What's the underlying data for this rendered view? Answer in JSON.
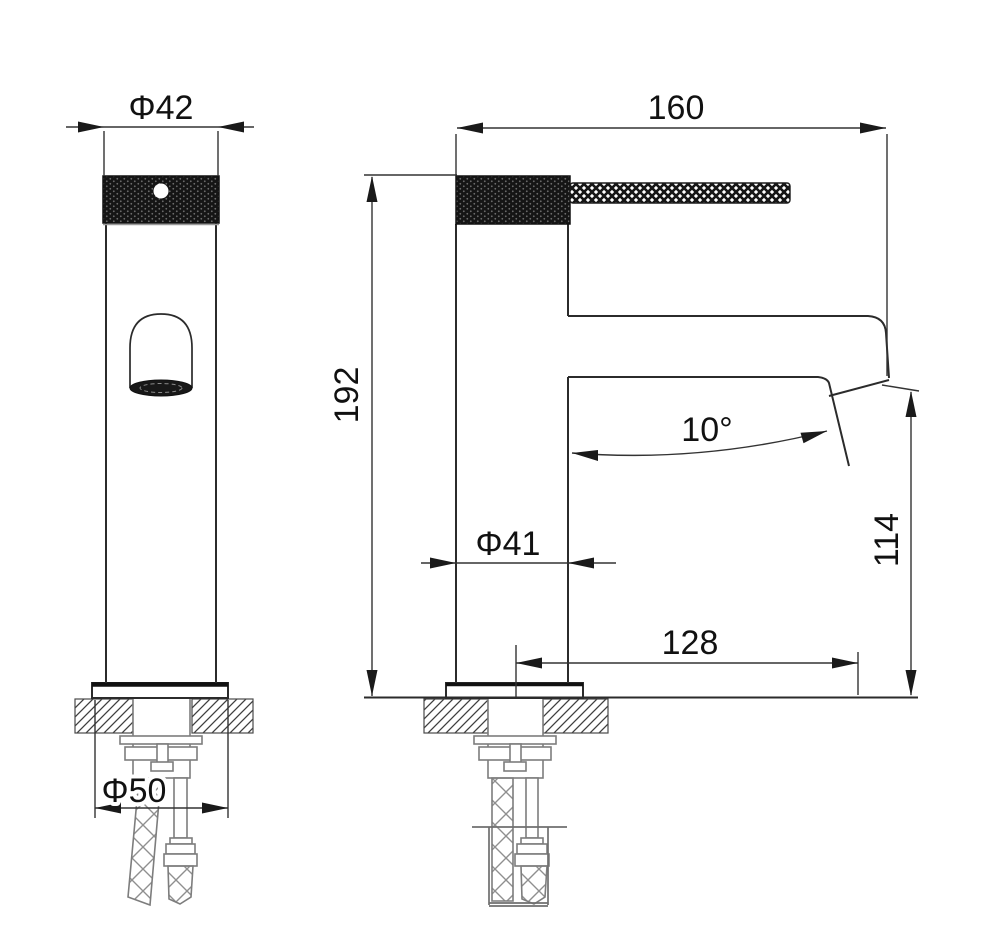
{
  "product": "Single-handle basin faucet technical drawing",
  "units": "mm",
  "colors": {
    "object_line": "#2b2b2b",
    "dimension_line": "#333333",
    "text": "#111111",
    "hidden_part_gray": "#7d7d7d",
    "background": "#ffffff"
  },
  "views": {
    "front": {
      "name": "Front view",
      "dims": {
        "cap_diameter": "Φ42",
        "base_diameter": "Φ50"
      }
    },
    "side": {
      "name": "Side view",
      "dims": {
        "overall_width": "160",
        "overall_height": "192",
        "body_diameter": "Φ41",
        "spout_reach": "128",
        "outlet_height": "114",
        "spout_angle": "10°"
      }
    }
  }
}
